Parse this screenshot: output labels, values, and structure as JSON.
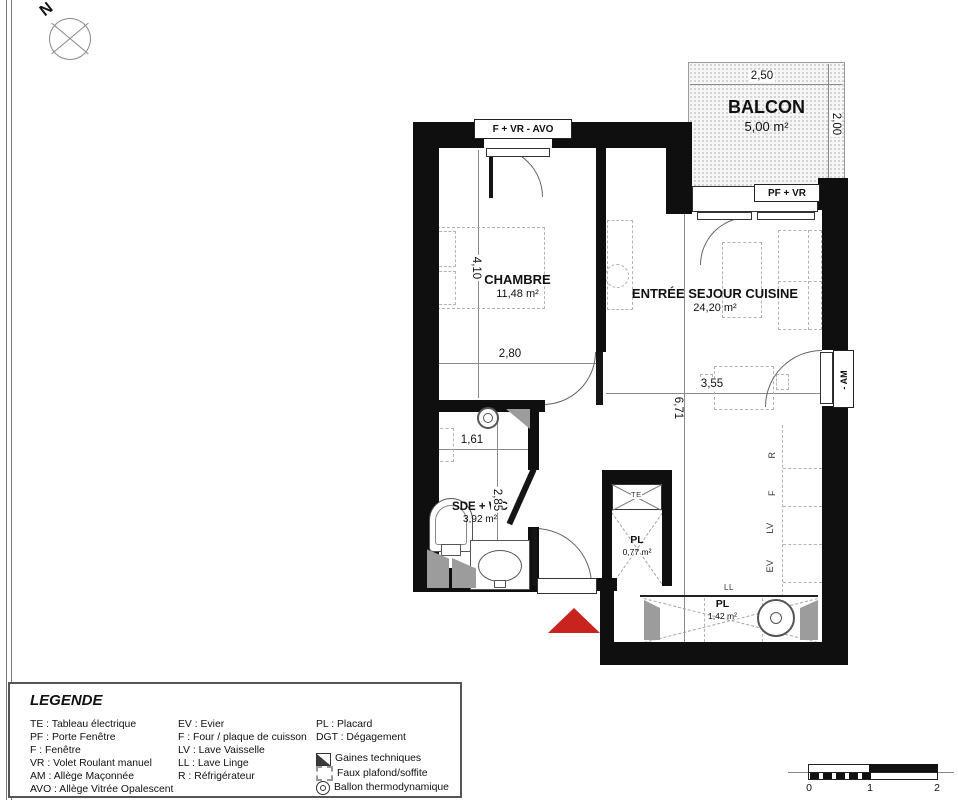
{
  "compass": {
    "label": "N"
  },
  "plan": {
    "rooms": {
      "balcon": {
        "name": "BALCON",
        "area": "5,00 m²"
      },
      "chambre": {
        "name": "CHAMBRE",
        "area": "11,48 m²"
      },
      "sejour": {
        "name": "ENTRÉE SEJOUR CUISINE",
        "area": "24,20 m²"
      },
      "sde": {
        "name": "SDE + WC",
        "area": "3,92 m²"
      },
      "placard_entree": {
        "name": "PL",
        "area": "0,77 m²"
      },
      "placard_bas": {
        "name": "PL",
        "area": "1,42 m²"
      }
    },
    "openings": {
      "fenetre_chambre": "F + VR - AVO",
      "porte_fenetre_balcon": "PF + VR",
      "fenetre_cuisine": "- AM"
    },
    "dimensions": {
      "balcon_largeur": "2,50",
      "balcon_profondeur": "2,00",
      "chambre_longueur": "4,10",
      "chambre_largeur": "2,80",
      "sde_largeur": "1,61",
      "sde_longueur": "2,85",
      "sejour_largeur": "3,55",
      "sejour_longueur": "6,71"
    },
    "equipements": {
      "te": "TE",
      "r": "R",
      "f": "F",
      "lv": "LV",
      "ev": "EV",
      "ll": "LL"
    },
    "entrance_color": "#c9231f"
  },
  "legend": {
    "title": "LEGENDE",
    "separator": " : ",
    "col1": [
      {
        "abbr": "TE",
        "label": "Tableau électrique"
      },
      {
        "abbr": "PF",
        "label": "Porte Fenêtre"
      },
      {
        "abbr": "F",
        "label": "Fenêtre"
      },
      {
        "abbr": "VR",
        "label": "Volet Roulant manuel"
      },
      {
        "abbr": "AM",
        "label": "Allège Maçonnée"
      },
      {
        "abbr": "AVO",
        "label": "Allège Vitrée Opalescent"
      }
    ],
    "col2": [
      {
        "abbr": "EV",
        "label": "Evier"
      },
      {
        "abbr": "F",
        "label": "Four / plaque de cuisson"
      },
      {
        "abbr": "LV",
        "label": "Lave Vaisselle"
      },
      {
        "abbr": "LL",
        "label": "Lave Linge"
      },
      {
        "abbr": "R",
        "label": "Réfrigérateur"
      }
    ],
    "col3": [
      {
        "abbr": "PL",
        "label": "Placard"
      },
      {
        "abbr": "DGT",
        "label": "Dégagement"
      }
    ],
    "symbols": [
      {
        "label": "Gaines techniques"
      },
      {
        "label": "Faux plafond/soffite"
      },
      {
        "label": "Ballon thermodynamique"
      }
    ]
  },
  "scalebar": {
    "labels": [
      "0",
      "1",
      "2"
    ]
  }
}
